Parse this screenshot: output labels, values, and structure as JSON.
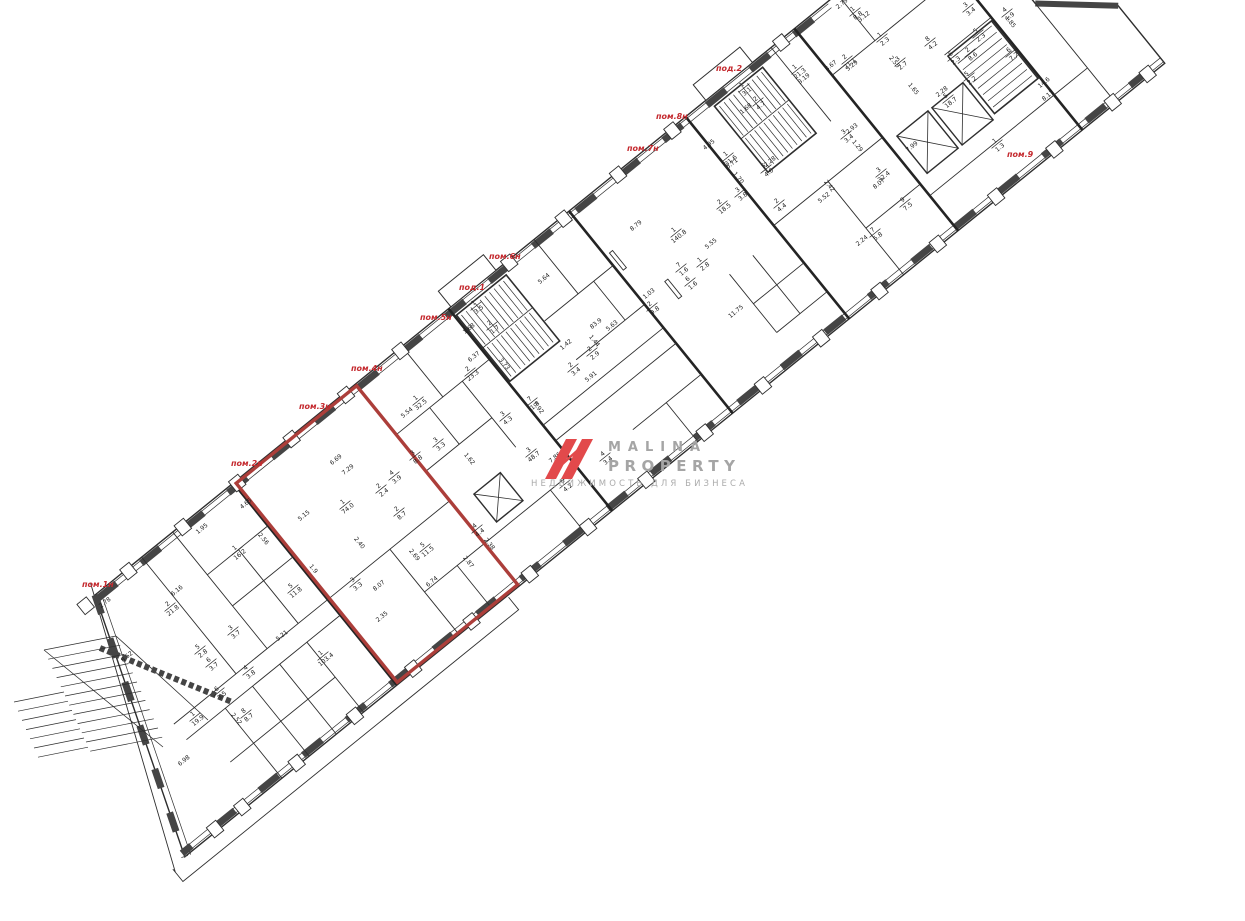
{
  "watermark": {
    "title1": "MALINA",
    "title2": "PROPERTY",
    "subtitle": "НЕДВИЖИМОСТЬ ДЛЯ БИЗНЕСА"
  },
  "colors": {
    "plan_line": "#2e2e2e",
    "wall_dark": "#454545",
    "unit_label_red": "#c4292e",
    "highlight_red": "#ac3e3a",
    "logo_red": "#e2494b",
    "wm_gray": "#a5a5a5",
    "wm_sub_gray": "#ababab"
  },
  "unit_labels": [
    {
      "text": "пом.1н",
      "x": 82,
      "y": 587
    },
    {
      "text": "пом.2н",
      "x": 231,
      "y": 466
    },
    {
      "text": "пом.3н",
      "x": 299,
      "y": 409
    },
    {
      "text": "пом.4н",
      "x": 351,
      "y": 371
    },
    {
      "text": "пом.5н",
      "x": 420,
      "y": 320
    },
    {
      "text": "под.1",
      "x": 459,
      "y": 290
    },
    {
      "text": "пом.6н",
      "x": 489,
      "y": 259
    },
    {
      "text": "пом.7н",
      "x": 627,
      "y": 151
    },
    {
      "text": "пом.8н",
      "x": 656,
      "y": 119
    },
    {
      "text": "под.2",
      "x": 716,
      "y": 71
    },
    {
      "text": "пом.9",
      "x": 1007,
      "y": 157
    }
  ],
  "room_labels": [
    {
      "n": "1",
      "a": "16.2",
      "x": 237,
      "y": 551
    },
    {
      "n": "2",
      "a": "21.8",
      "x": 170,
      "y": 607
    },
    {
      "n": "3",
      "a": "3.7",
      "x": 233,
      "y": 631
    },
    {
      "n": "5",
      "a": "2.8",
      "x": 200,
      "y": 650
    },
    {
      "n": "6",
      "a": "3.7",
      "x": 211,
      "y": 663
    },
    {
      "n": "4",
      "a": "3.8",
      "x": 248,
      "y": 671
    },
    {
      "n": "6",
      "a": "3.5",
      "x": 219,
      "y": 692
    },
    {
      "n": "1",
      "a": "19.9",
      "x": 195,
      "y": 717
    },
    {
      "n": "8",
      "a": "8.7",
      "x": 246,
      "y": 714
    },
    {
      "n": "5",
      "a": "11.8",
      "x": 293,
      "y": 589
    },
    {
      "n": "1",
      "a": "74.0",
      "x": 345,
      "y": 505
    },
    {
      "n": "3",
      "a": "3.3",
      "x": 438,
      "y": 443
    },
    {
      "n": "3",
      "a": "8.8",
      "x": 415,
      "y": 456
    },
    {
      "n": "4",
      "a": "3.9",
      "x": 394,
      "y": 476
    },
    {
      "n": "2",
      "a": "2.4",
      "x": 381,
      "y": 489
    },
    {
      "n": "2",
      "a": "8.7",
      "x": 399,
      "y": 512
    },
    {
      "n": "5",
      "a": "11.5",
      "x": 425,
      "y": 548
    },
    {
      "n": "4",
      "a": "4.4",
      "x": 477,
      "y": 529
    },
    {
      "n": "3",
      "a": "3.3",
      "x": 355,
      "y": 583
    },
    {
      "n": "1",
      "a": "103.4",
      "x": 323,
      "y": 656
    },
    {
      "n": "1",
      "a": "32.5",
      "x": 418,
      "y": 401
    },
    {
      "n": "2",
      "a": "23.3",
      "x": 470,
      "y": 372
    },
    {
      "n": "1",
      "a": "3.5",
      "x": 476,
      "y": 306
    },
    {
      "n": "2",
      "a": "1.7",
      "x": 492,
      "y": 326
    },
    {
      "n": "2",
      "a": "2.9",
      "x": 592,
      "y": 352
    },
    {
      "n": "2",
      "a": "3.4",
      "x": 573,
      "y": 368
    },
    {
      "n": "7",
      "a": "1.8",
      "x": 532,
      "y": 402
    },
    {
      "n": "3",
      "a": "4.3",
      "x": 505,
      "y": 417
    },
    {
      "n": "3",
      "a": "48.7",
      "x": 531,
      "y": 453
    },
    {
      "n": "5",
      "a": "4.2",
      "x": 565,
      "y": 484
    },
    {
      "n": "4",
      "a": "3.4",
      "x": 605,
      "y": 457
    },
    {
      "n": "2",
      "a": "9.8",
      "x": 652,
      "y": 307
    },
    {
      "n": "1",
      "a": "140.8",
      "x": 676,
      "y": 233
    },
    {
      "n": "7",
      "a": "1.6",
      "x": 681,
      "y": 268
    },
    {
      "n": "6",
      "a": "1.6",
      "x": 690,
      "y": 282
    },
    {
      "n": "1",
      "a": "2.8",
      "x": 702,
      "y": 263
    },
    {
      "n": "3",
      "a": "3.8",
      "x": 740,
      "y": 193
    },
    {
      "n": "2",
      "a": "18.5",
      "x": 722,
      "y": 205
    },
    {
      "n": "1",
      "a": "31.6",
      "x": 728,
      "y": 157
    },
    {
      "n": "5",
      "a": "4.0",
      "x": 766,
      "y": 169
    },
    {
      "n": "1",
      "a": "21.3",
      "x": 797,
      "y": 70
    },
    {
      "n": "2",
      "a": "21.1",
      "x": 847,
      "y": 60
    },
    {
      "n": "1",
      "a": "8.8",
      "x": 855,
      "y": 12
    },
    {
      "n": "1",
      "a": "2.3",
      "x": 882,
      "y": 38
    },
    {
      "n": "3",
      "a": "2.7",
      "x": 900,
      "y": 62
    },
    {
      "n": "1",
      "a": "3.1",
      "x": 744,
      "y": 88
    },
    {
      "n": "2",
      "a": "4.7",
      "x": 758,
      "y": 102
    },
    {
      "n": "2",
      "a": "4.4",
      "x": 779,
      "y": 204
    },
    {
      "n": "3",
      "a": "32.4",
      "x": 881,
      "y": 173
    },
    {
      "n": "3",
      "a": "3.4",
      "x": 846,
      "y": 135
    },
    {
      "n": "9",
      "a": "7.5",
      "x": 905,
      "y": 203
    },
    {
      "n": "7",
      "a": "5.8",
      "x": 875,
      "y": 233
    },
    {
      "n": "1",
      "a": "1.3",
      "x": 997,
      "y": 144
    },
    {
      "n": "3",
      "a": "3.4",
      "x": 968,
      "y": 8
    },
    {
      "n": "8",
      "a": "4.2",
      "x": 930,
      "y": 42
    },
    {
      "n": "5",
      "a": "2.3",
      "x": 978,
      "y": 34
    },
    {
      "n": "6",
      "a": "2.3",
      "x": 953,
      "y": 57
    },
    {
      "n": "2",
      "a": "8.6",
      "x": 970,
      "y": 53
    },
    {
      "n": "6",
      "a": "7.2",
      "x": 1011,
      "y": 53
    },
    {
      "n": "5",
      "a": "2.2",
      "x": 969,
      "y": 77
    },
    {
      "n": "5",
      "a": "18.7",
      "x": 948,
      "y": 99
    },
    {
      "n": "4",
      "a": "1.9",
      "x": 1007,
      "y": 13
    }
  ],
  "dim_labels": [
    {
      "t": "2.78",
      "x": 106,
      "y": 604
    },
    {
      "t": "6.16",
      "x": 178,
      "y": 592
    },
    {
      "t": "1.95",
      "x": 203,
      "y": 530
    },
    {
      "t": "2.56",
      "x": 262,
      "y": 540,
      "r": 51
    },
    {
      "t": "4.65",
      "x": 247,
      "y": 505
    },
    {
      "t": "8.52",
      "x": 128,
      "y": 658
    },
    {
      "t": "6.98",
      "x": 185,
      "y": 762
    },
    {
      "t": "2.52",
      "x": 235,
      "y": 720,
      "r": 51
    },
    {
      "t": "5.21",
      "x": 283,
      "y": 637
    },
    {
      "t": "6.69",
      "x": 337,
      "y": 461
    },
    {
      "t": "7.29",
      "x": 349,
      "y": 471
    },
    {
      "t": "5.15",
      "x": 305,
      "y": 517
    },
    {
      "t": "2.40",
      "x": 358,
      "y": 544,
      "r": 51
    },
    {
      "t": "8.07",
      "x": 380,
      "y": 587
    },
    {
      "t": "2.35",
      "x": 383,
      "y": 618
    },
    {
      "t": "6.74",
      "x": 433,
      "y": 583
    },
    {
      "t": "2.87",
      "x": 467,
      "y": 563,
      "r": 51
    },
    {
      "t": "2.69",
      "x": 413,
      "y": 556,
      "r": 51
    },
    {
      "t": "1.9",
      "x": 312,
      "y": 570,
      "r": 51
    },
    {
      "t": "1.62",
      "x": 468,
      "y": 460,
      "r": 51
    },
    {
      "t": "2.38",
      "x": 488,
      "y": 545,
      "r": 51
    },
    {
      "t": "5.54",
      "x": 408,
      "y": 414
    },
    {
      "t": "6.37",
      "x": 475,
      "y": 358
    },
    {
      "t": "3.73",
      "x": 503,
      "y": 365,
      "r": 51
    },
    {
      "t": "1.68",
      "x": 470,
      "y": 330
    },
    {
      "t": "5.64",
      "x": 545,
      "y": 280
    },
    {
      "t": "5.91",
      "x": 592,
      "y": 378
    },
    {
      "t": "1.42",
      "x": 567,
      "y": 346
    },
    {
      "t": "0.92",
      "x": 537,
      "y": 409,
      "r": 51
    },
    {
      "t": "7.86",
      "x": 556,
      "y": 459
    },
    {
      "t": "83.9",
      "x": 597,
      "y": 325
    },
    {
      "t": "5.63",
      "x": 613,
      "y": 327
    },
    {
      "t": "1.03",
      "x": 650,
      "y": 295
    },
    {
      "t": "1.44",
      "x": 593,
      "y": 342,
      "r": 51
    },
    {
      "t": "8.79",
      "x": 637,
      "y": 227
    },
    {
      "t": "5.55",
      "x": 712,
      "y": 245
    },
    {
      "t": "11.75",
      "x": 737,
      "y": 313
    },
    {
      "t": "3.19",
      "x": 805,
      "y": 80
    },
    {
      "t": "8.67",
      "x": 832,
      "y": 67
    },
    {
      "t": "3.29",
      "x": 853,
      "y": 67
    },
    {
      "t": "3.12",
      "x": 865,
      "y": 18
    },
    {
      "t": "2.79",
      "x": 843,
      "y": 5
    },
    {
      "t": "2.55",
      "x": 893,
      "y": 63,
      "r": 51
    },
    {
      "t": "1.68",
      "x": 747,
      "y": 110
    },
    {
      "t": "1.65",
      "x": 912,
      "y": 90,
      "r": 51
    },
    {
      "t": "6.71",
      "x": 733,
      "y": 165
    },
    {
      "t": "4.95",
      "x": 710,
      "y": 146
    },
    {
      "t": "2.28",
      "x": 771,
      "y": 163
    },
    {
      "t": "1.70",
      "x": 737,
      "y": 179,
      "r": 51
    },
    {
      "t": "2.93",
      "x": 853,
      "y": 130
    },
    {
      "t": "1.29",
      "x": 856,
      "y": 147,
      "r": 51
    },
    {
      "t": "8.07",
      "x": 880,
      "y": 185
    },
    {
      "t": "2.42",
      "x": 828,
      "y": 187,
      "r": 51
    },
    {
      "t": "5.52",
      "x": 825,
      "y": 199
    },
    {
      "t": "2.24",
      "x": 863,
      "y": 242
    },
    {
      "t": "7.99",
      "x": 913,
      "y": 148
    },
    {
      "t": "2.28",
      "x": 943,
      "y": 93
    },
    {
      "t": "1.85",
      "x": 1009,
      "y": 23,
      "r": 51
    },
    {
      "t": "14.6",
      "x": 1045,
      "y": 84
    },
    {
      "t": "8.17",
      "x": 1049,
      "y": 97
    }
  ]
}
